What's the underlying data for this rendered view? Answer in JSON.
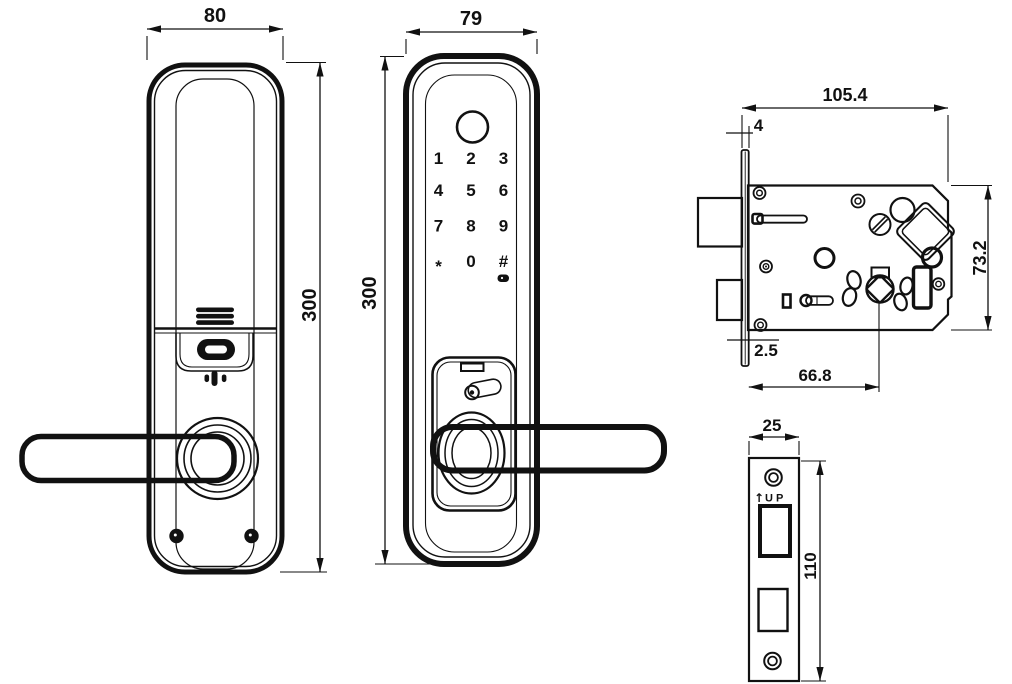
{
  "views": {
    "back": {
      "width": "80",
      "height": "300"
    },
    "front": {
      "width": "79",
      "height": "300",
      "keypad": [
        "1",
        "2",
        "3",
        "4",
        "5",
        "6",
        "7",
        "8",
        "9",
        "*",
        "0",
        "#"
      ]
    },
    "mortise": {
      "total_width": "105.4",
      "faceplate_width": "4",
      "body_height": "73.2",
      "faceplate_thickness": "2.5",
      "backset": "66.8"
    },
    "strike_plate": {
      "width": "25",
      "height": "110",
      "up_arrow": "↑",
      "up_label": "UP"
    }
  }
}
